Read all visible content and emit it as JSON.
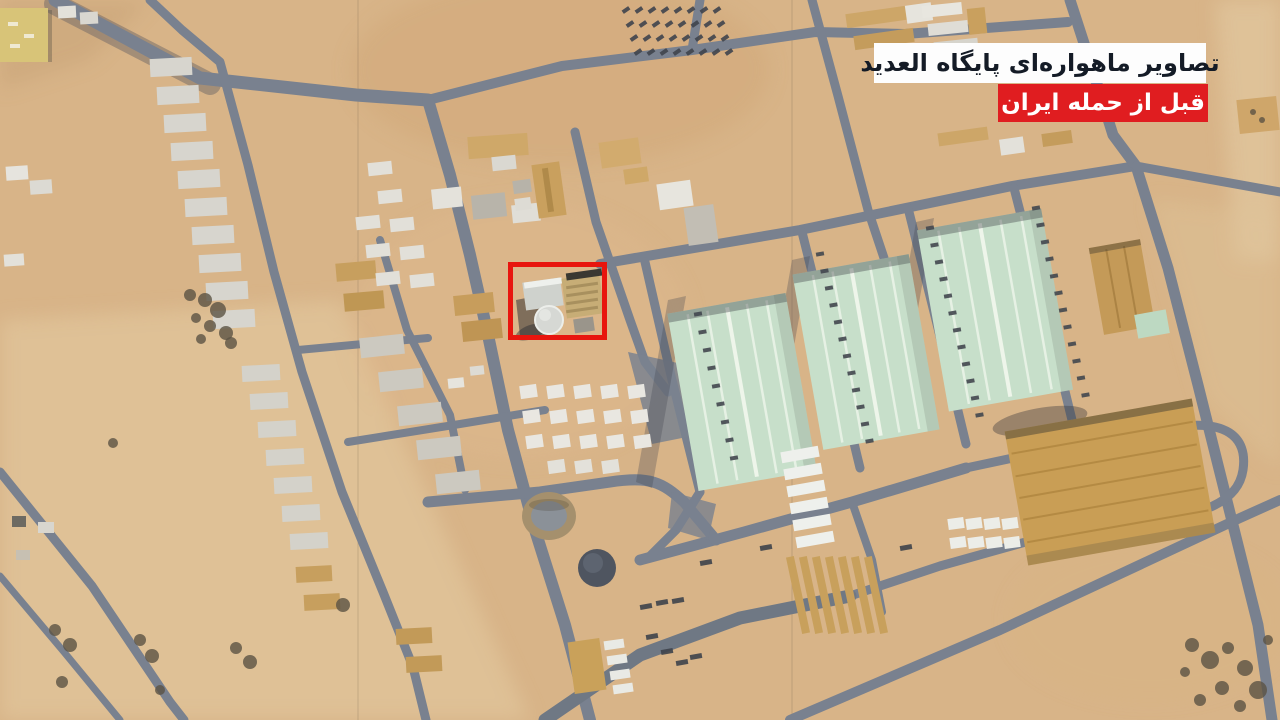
{
  "overlay": {
    "headline": "تصاویر ماهواره‌ای پایگاه العدید",
    "subhead": "قبل از حمله ایران"
  },
  "annotation": {
    "shape": "rectangle",
    "purpose": "highlighted-structures"
  },
  "palette": {
    "banner_white": "#fdfdfd",
    "banner_red": "#e01d20",
    "headline_text": "#141b26",
    "subhead_text": "#ffffff",
    "highlight_red": "#e8150e",
    "sand": "#d8b488",
    "road_gray": "#79818f",
    "hangar_green": "#c7dfca",
    "warehouse_tan": "#c99e55"
  }
}
